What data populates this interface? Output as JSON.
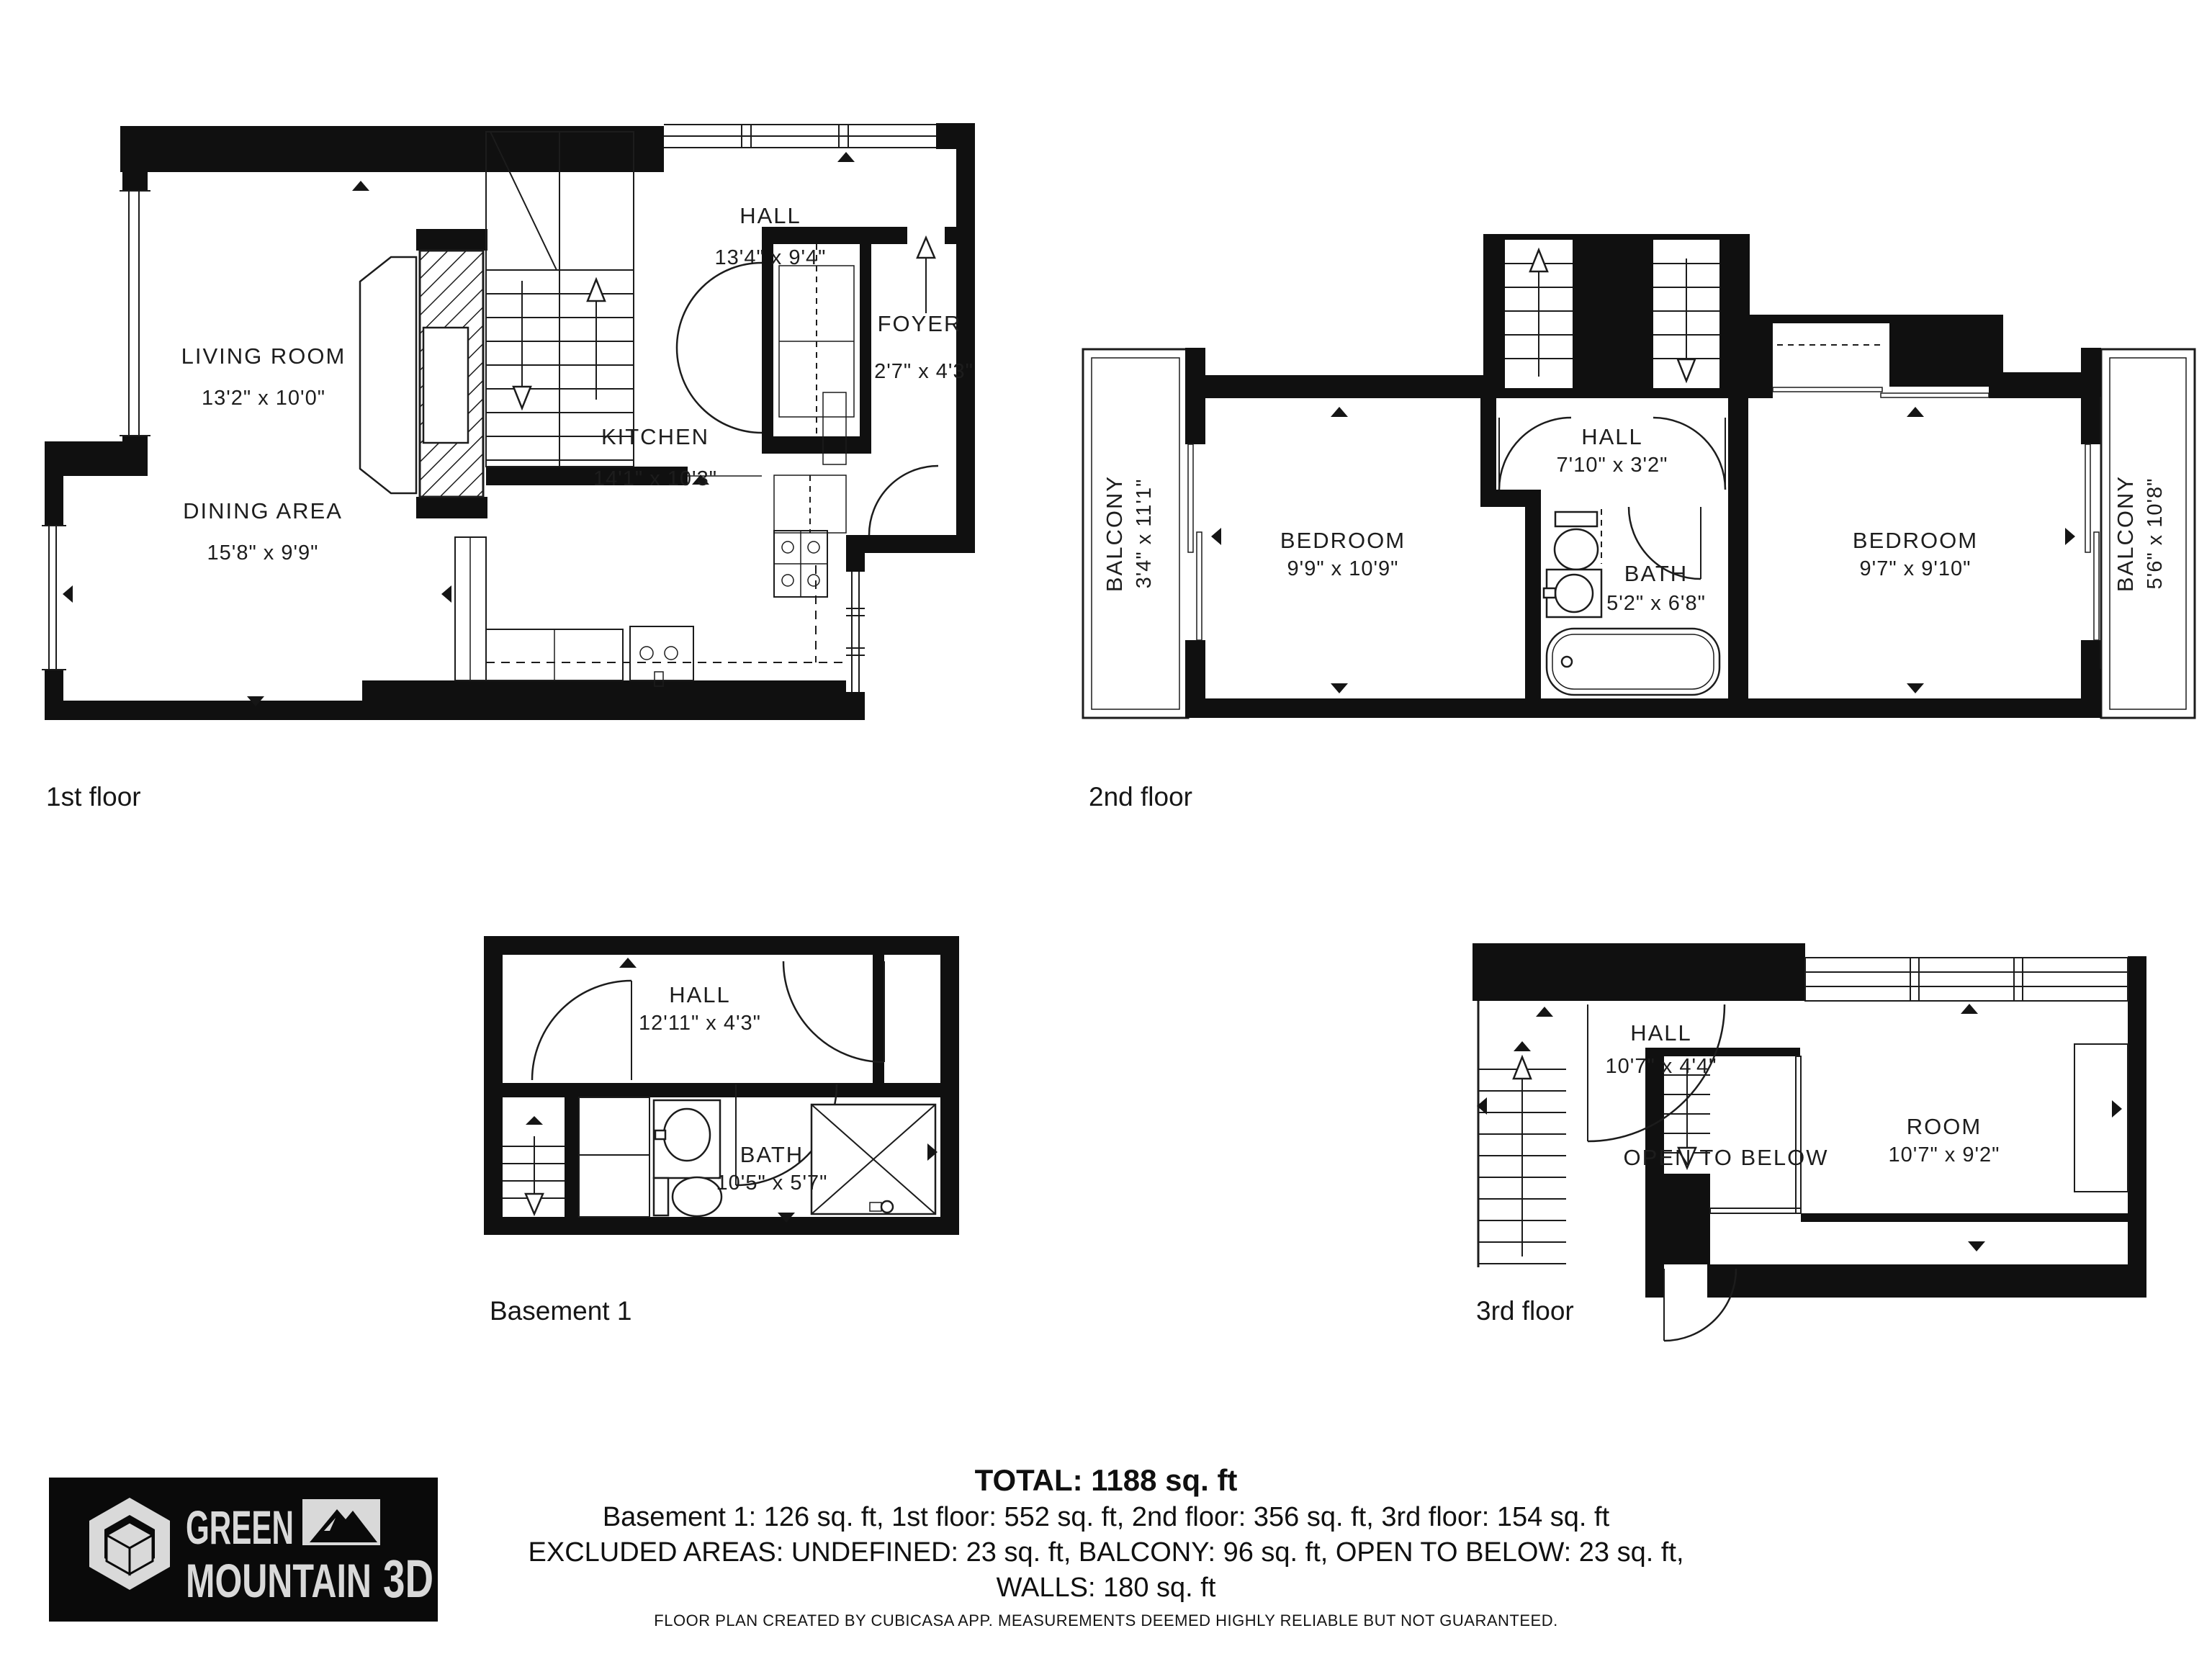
{
  "floors": {
    "first": {
      "label": "1st floor",
      "rooms": {
        "living": {
          "name": "LIVING ROOM",
          "dims": "13'2\" x 10'0\""
        },
        "dining": {
          "name": "DINING AREA",
          "dims": "15'8\" x 9'9\""
        },
        "kitchen": {
          "name": "KITCHEN",
          "dims": "14'1\" x 10'3\""
        },
        "hall": {
          "name": "HALL",
          "dims": "13'4\" x 9'4\""
        },
        "foyer": {
          "name": "FOYER",
          "dims": "2'7\" x 4'3\""
        }
      }
    },
    "second": {
      "label": "2nd floor",
      "rooms": {
        "balcony_left": {
          "name": "BALCONY",
          "dims": "3'4\" x 11'1\""
        },
        "bedroom_left": {
          "name": "BEDROOM",
          "dims": "9'9\" x 10'9\""
        },
        "hall": {
          "name": "HALL",
          "dims": "7'10\" x 3'2\""
        },
        "bath": {
          "name": "BATH",
          "dims": "5'2\" x 6'8\""
        },
        "bedroom_right": {
          "name": "BEDROOM",
          "dims": "9'7\" x 9'10\""
        },
        "balcony_right": {
          "name": "BALCONY",
          "dims": "5'6\" x 10'8\""
        }
      }
    },
    "basement": {
      "label": "Basement 1",
      "rooms": {
        "hall": {
          "name": "HALL",
          "dims": "12'11\" x 4'3\""
        },
        "bath": {
          "name": "BATH",
          "dims": "10'5\" x 5'7\""
        }
      }
    },
    "third": {
      "label": "3rd floor",
      "rooms": {
        "hall": {
          "name": "HALL",
          "dims": "10'7\" x 4'4\""
        },
        "room": {
          "name": "ROOM",
          "dims": "10'7\" x 9'2\""
        },
        "open_to_below": {
          "name": "OPEN TO BELOW"
        }
      }
    }
  },
  "summary": {
    "total": "TOTAL: 1188 sq. ft",
    "breakdown": "Basement 1: 126 sq. ft, 1st floor: 552 sq. ft, 2nd floor: 356 sq. ft, 3rd floor: 154 sq. ft",
    "excluded": "EXCLUDED AREAS: UNDEFINED: 23 sq. ft, BALCONY: 96 sq. ft, OPEN TO BELOW: 23 sq. ft,",
    "walls": "WALLS: 180 sq. ft"
  },
  "disclaimer": "FLOOR PLAN CREATED BY CUBICASA APP. MEASUREMENTS DEEMED HIGHLY RELIABLE BUT NOT GUARANTEED.",
  "logo": {
    "word1": "GREEN",
    "word2": "MOUNTAIN",
    "word3": "3D",
    "bg": "#0a0a0a",
    "fg": "#d9d9d9"
  }
}
